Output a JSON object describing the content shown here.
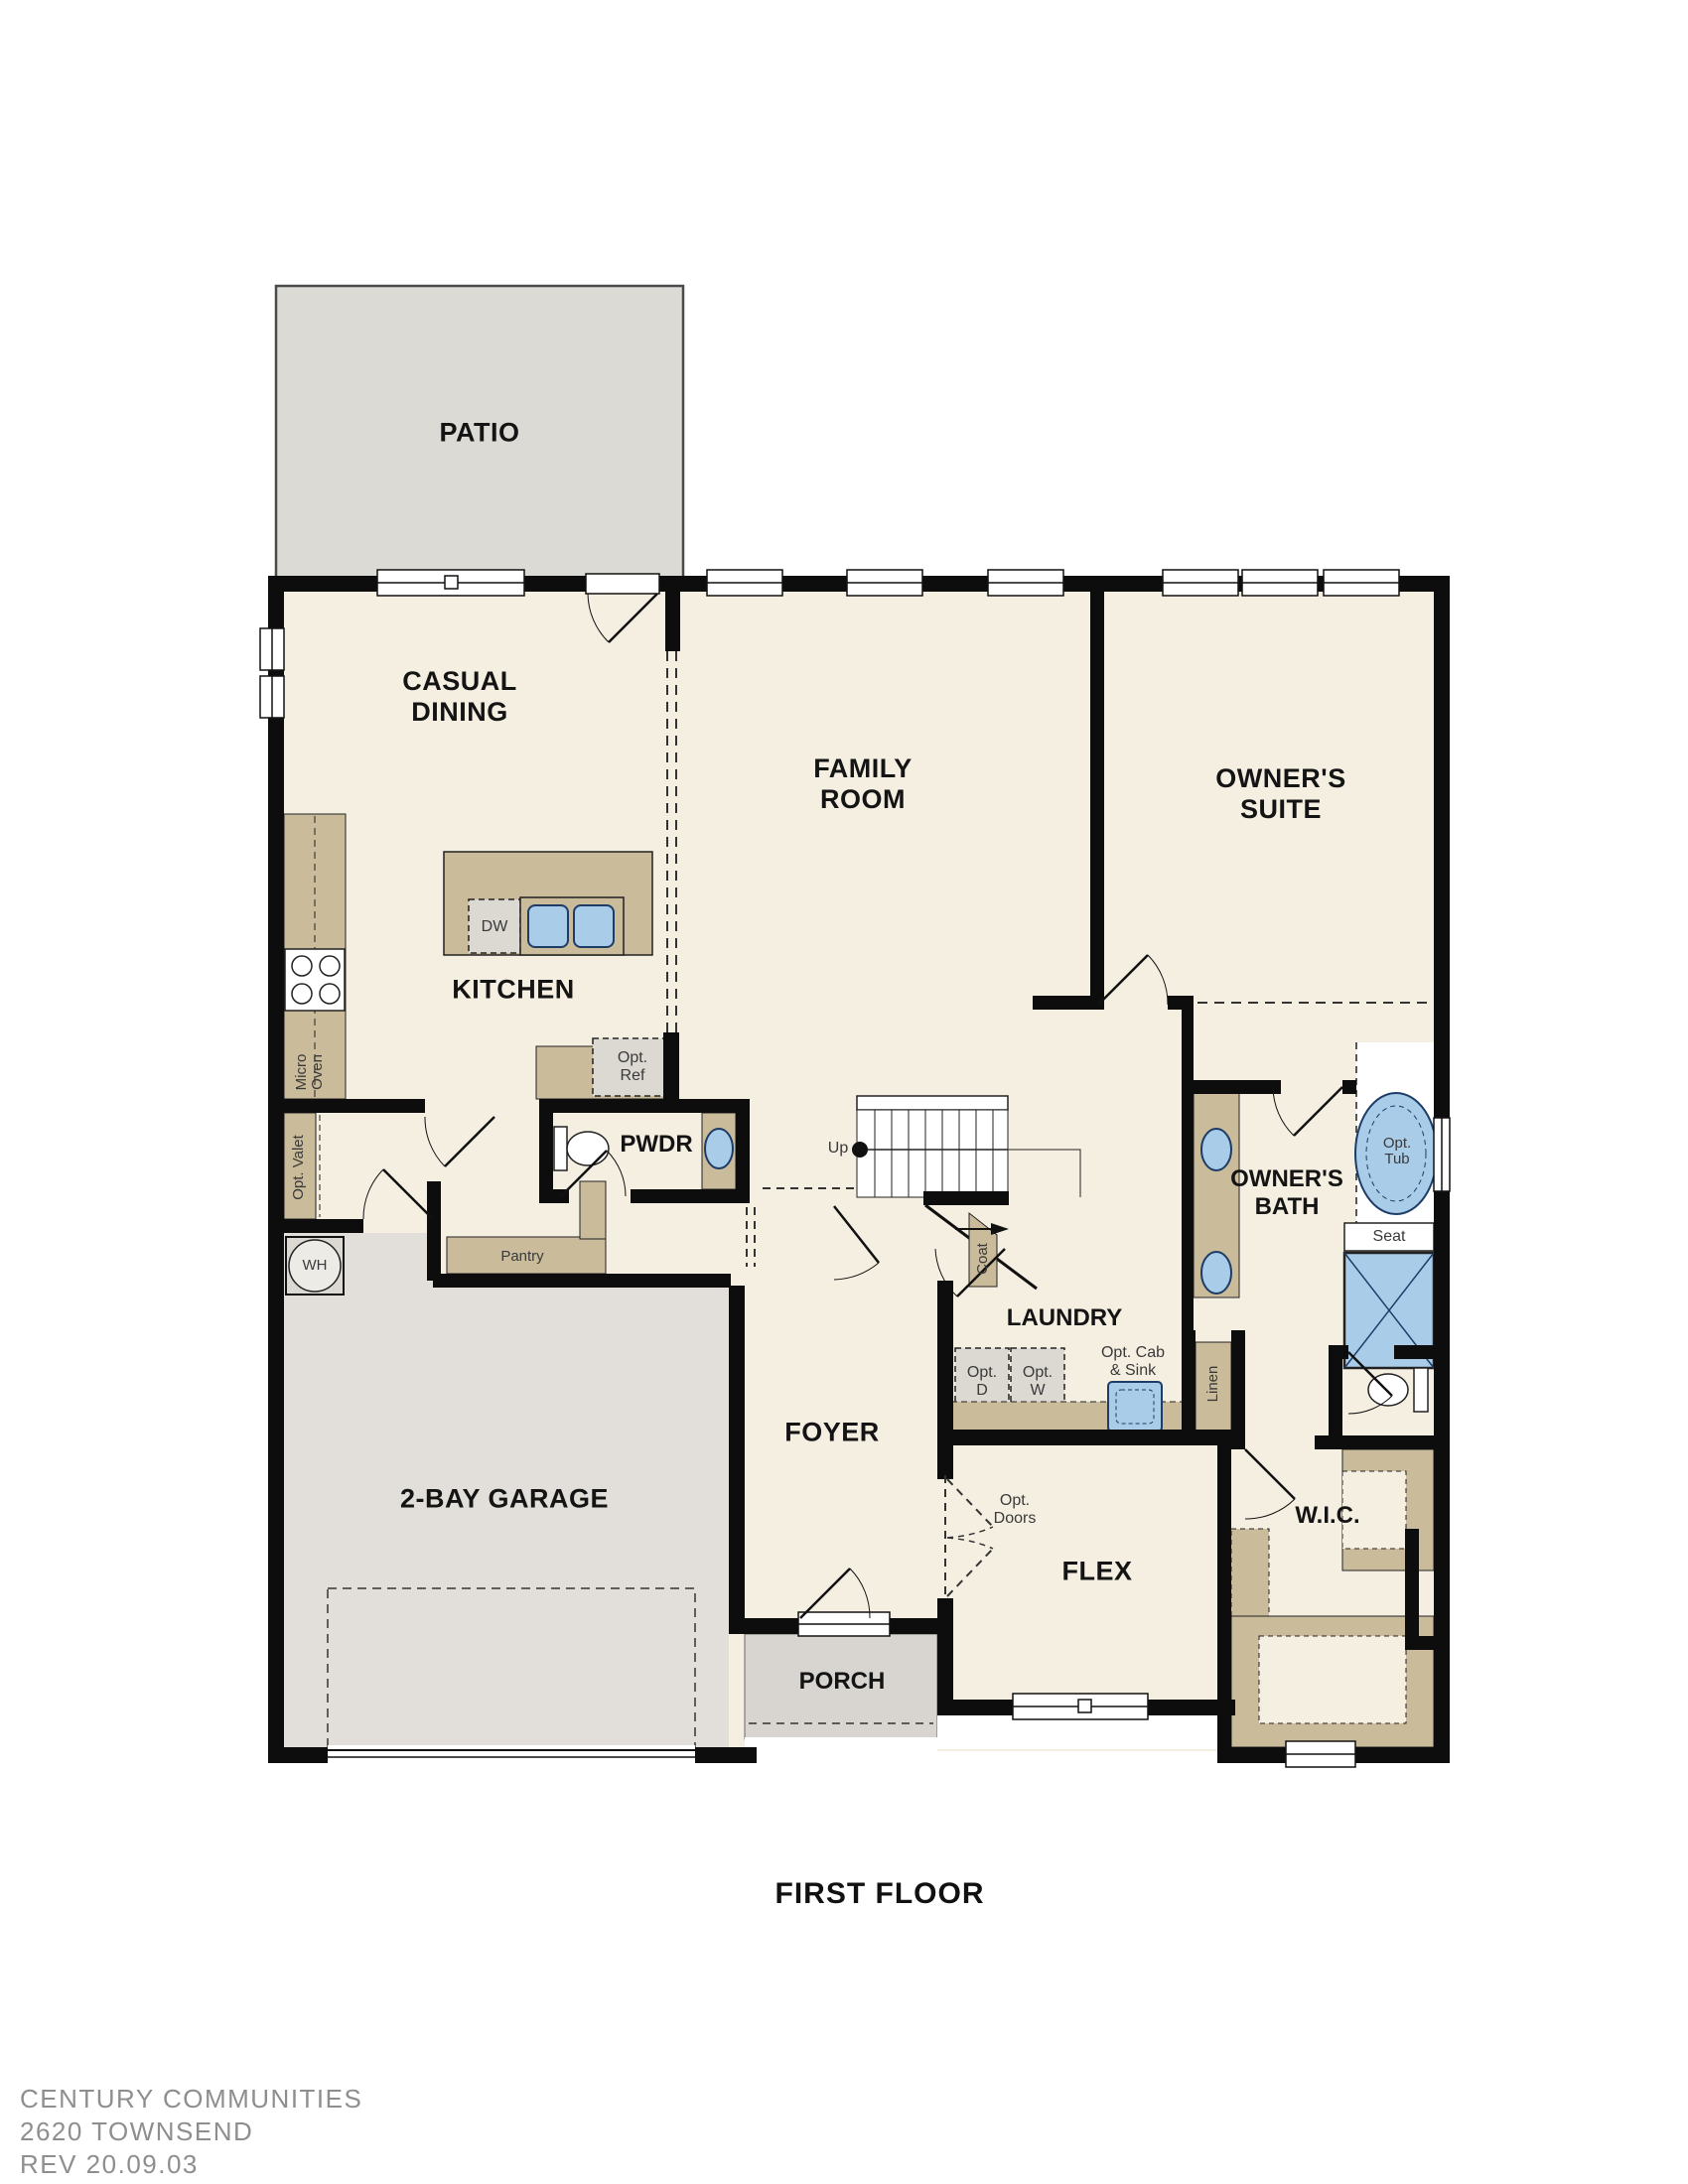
{
  "title": {
    "floor": "FIRST FLOOR"
  },
  "rooms": {
    "patio": {
      "label": "PATIO"
    },
    "casual_dining": {
      "line1": "CASUAL",
      "line2": "DINING"
    },
    "family_room": {
      "line1": "FAMILY",
      "line2": "ROOM"
    },
    "owners_suite": {
      "line1": "OWNER'S",
      "line2": "SUITE"
    },
    "kitchen": {
      "label": "KITCHEN"
    },
    "pwdr": {
      "label": "PWDR"
    },
    "owners_bath": {
      "line1": "OWNER'S",
      "line2": "BATH"
    },
    "laundry": {
      "label": "LAUNDRY"
    },
    "garage": {
      "label": "2-BAY GARAGE"
    },
    "foyer": {
      "label": "FOYER"
    },
    "flex": {
      "label": "FLEX"
    },
    "wic": {
      "label": "W.I.C."
    },
    "porch": {
      "label": "PORCH"
    }
  },
  "fixtures": {
    "dishwasher": "DW",
    "micro_oven": {
      "line1": "Micro",
      "line2": "Oven"
    },
    "opt_ref": {
      "line1": "Opt.",
      "line2": "Ref"
    },
    "opt_valet": "Opt. Valet",
    "water_heater": "WH",
    "pantry": "Pantry",
    "stairs_up": "Up",
    "coat": "Coat",
    "opt_dryer": {
      "line1": "Opt.",
      "line2": "D"
    },
    "opt_washer": {
      "line1": "Opt.",
      "line2": "W"
    },
    "opt_cab_sink": {
      "line1": "Opt. Cab",
      "line2": "& Sink"
    },
    "linen": "Linen",
    "opt_tub": {
      "line1": "Opt.",
      "line2": "Tub"
    },
    "seat": "Seat",
    "opt_doors": {
      "line1": "Opt.",
      "line2": "Doors"
    }
  },
  "footer": {
    "company": "CENTURY COMMUNITIES",
    "plan": "2620 TOWNSEND",
    "revision": "REV 20.09.03"
  },
  "colors": {
    "room_fill": "#f5efe2",
    "patio_fill": "#dcdad4",
    "garage_fill": "#e2dfda",
    "porch_fill": "#d8d5d0",
    "cabinet_tan": "#cabb9a",
    "fixture_blue": "#a9cce9",
    "fixture_blue_border": "#1d3c66",
    "appliance_gray": "#dcd9d3",
    "wall_black": "#0d0d0d",
    "footer_gray": "#8e8e8e"
  }
}
